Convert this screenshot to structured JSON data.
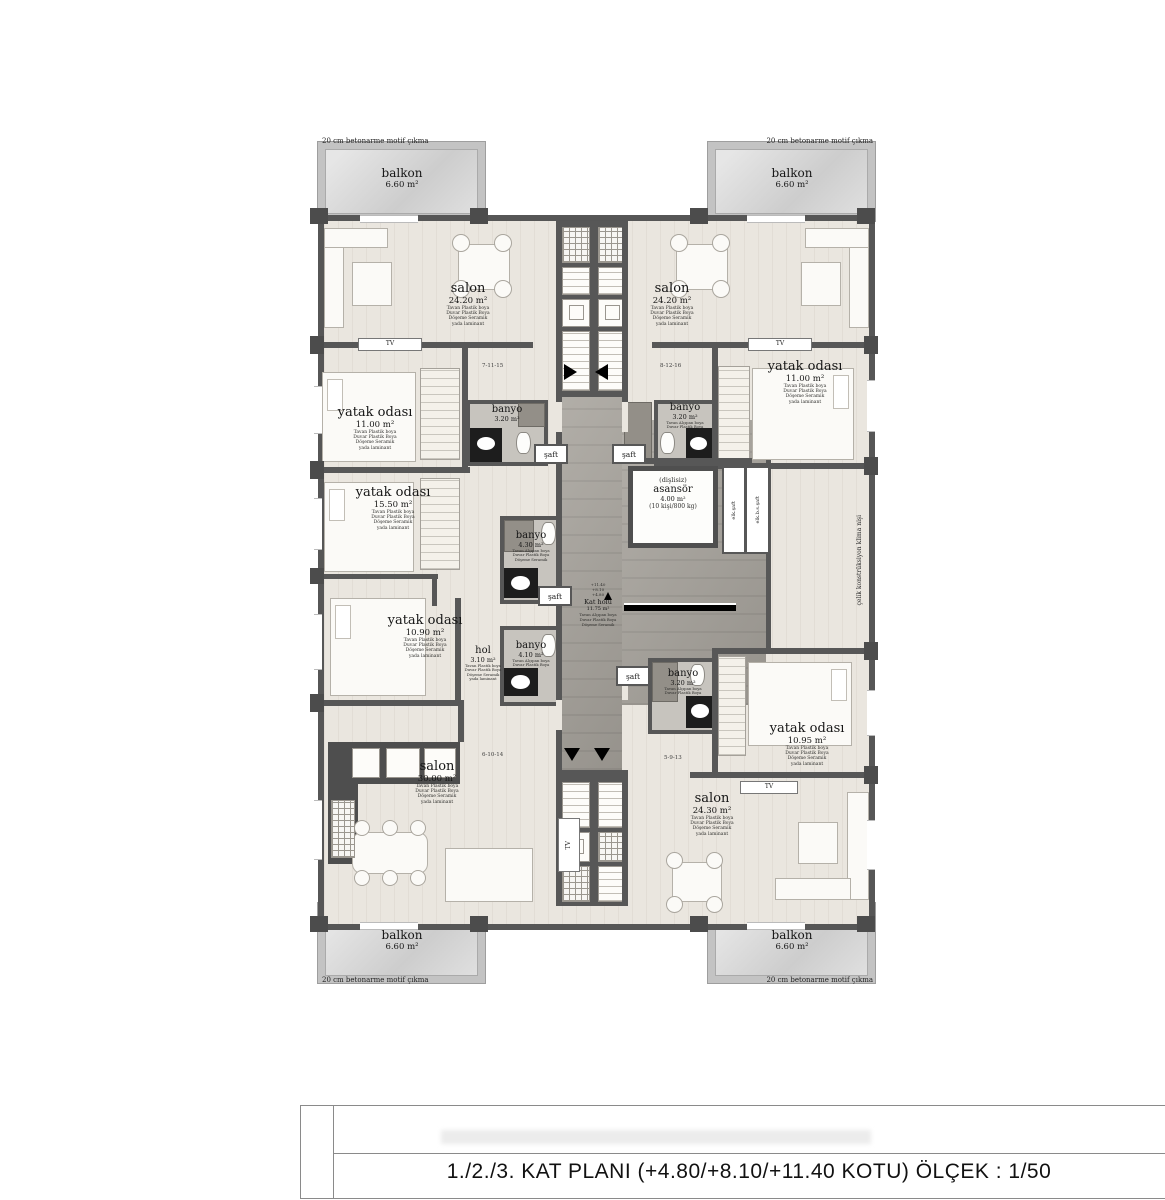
{
  "plan": {
    "edge_note": "20 cm betonarme motif çıkma",
    "side_note": "çelik konstrüksiyon klima nişi",
    "tv": "TV",
    "shaft": "şaft",
    "elk_shaft": "elk.şaft",
    "elk_bs_shaft": "elk.b.s.şaft",
    "units": {
      "top_left": "7-11-15",
      "top_right": "8-12-16",
      "bottom_left": "6-10-14",
      "bottom_right": "5-9-13"
    },
    "finish_living": [
      "Tavan Plastik boya",
      "Duvar Plastik Boya",
      "Döşeme Seramik",
      "yada laminant"
    ],
    "finish_bath": [
      "Tavan Alçıpan boya",
      "Duvar Plastik Boya",
      "Döşeme Seramik"
    ],
    "levels": [
      "+11.40",
      "+8.10",
      "+4.80"
    ],
    "rooms": {
      "balkon_tl": {
        "name": "balkon",
        "area": "6.60 m²"
      },
      "balkon_tr": {
        "name": "balkon",
        "area": "6.60 m²"
      },
      "balkon_bl": {
        "name": "balkon",
        "area": "6.60 m²"
      },
      "balkon_br": {
        "name": "balkon",
        "area": "6.60 m²"
      },
      "salon_tl": {
        "name": "salon",
        "area": "24.20 m²"
      },
      "salon_tr": {
        "name": "salon",
        "area": "24.20 m²"
      },
      "salon_bl": {
        "name": "salon",
        "area": "30.00 m²"
      },
      "salon_br": {
        "name": "salon",
        "area": "24.30 m²"
      },
      "yatak_tl": {
        "name": "yatak odası",
        "area": "11.00 m²"
      },
      "yatak_ml": {
        "name": "yatak odası",
        "area": "15.50 m²"
      },
      "yatak_bl": {
        "name": "yatak odası",
        "area": "10.90 m²"
      },
      "yatak_tr": {
        "name": "yatak odası",
        "area": "11.00 m²"
      },
      "yatak_br": {
        "name": "yatak odası",
        "area": "10.95 m²"
      },
      "banyo_tl": {
        "name": "banyo",
        "area": "3.20 m²"
      },
      "banyo_tr": {
        "name": "banyo",
        "area": "3.20 m²"
      },
      "banyo_ml": {
        "name": "banyo",
        "area": "4.30 m²"
      },
      "banyo_bl": {
        "name": "banyo",
        "area": "4.10 m²"
      },
      "banyo_br": {
        "name": "banyo",
        "area": "3.20 m²"
      },
      "hol": {
        "name": "hol",
        "area": "3.10 m²"
      },
      "kat_holu": {
        "name": "Kat holü",
        "area": "11.75 m²"
      },
      "asansor": {
        "prefix": "(dişlisiz)",
        "name": "asansör",
        "area": "4.00 m²",
        "capacity": "(10 kişi/800 kg)"
      }
    }
  },
  "title_block": {
    "title": "1./2./3. KAT PLANI (+4.80/+8.10/+11.40  KOTU)   ÖLÇEK : 1/50"
  }
}
